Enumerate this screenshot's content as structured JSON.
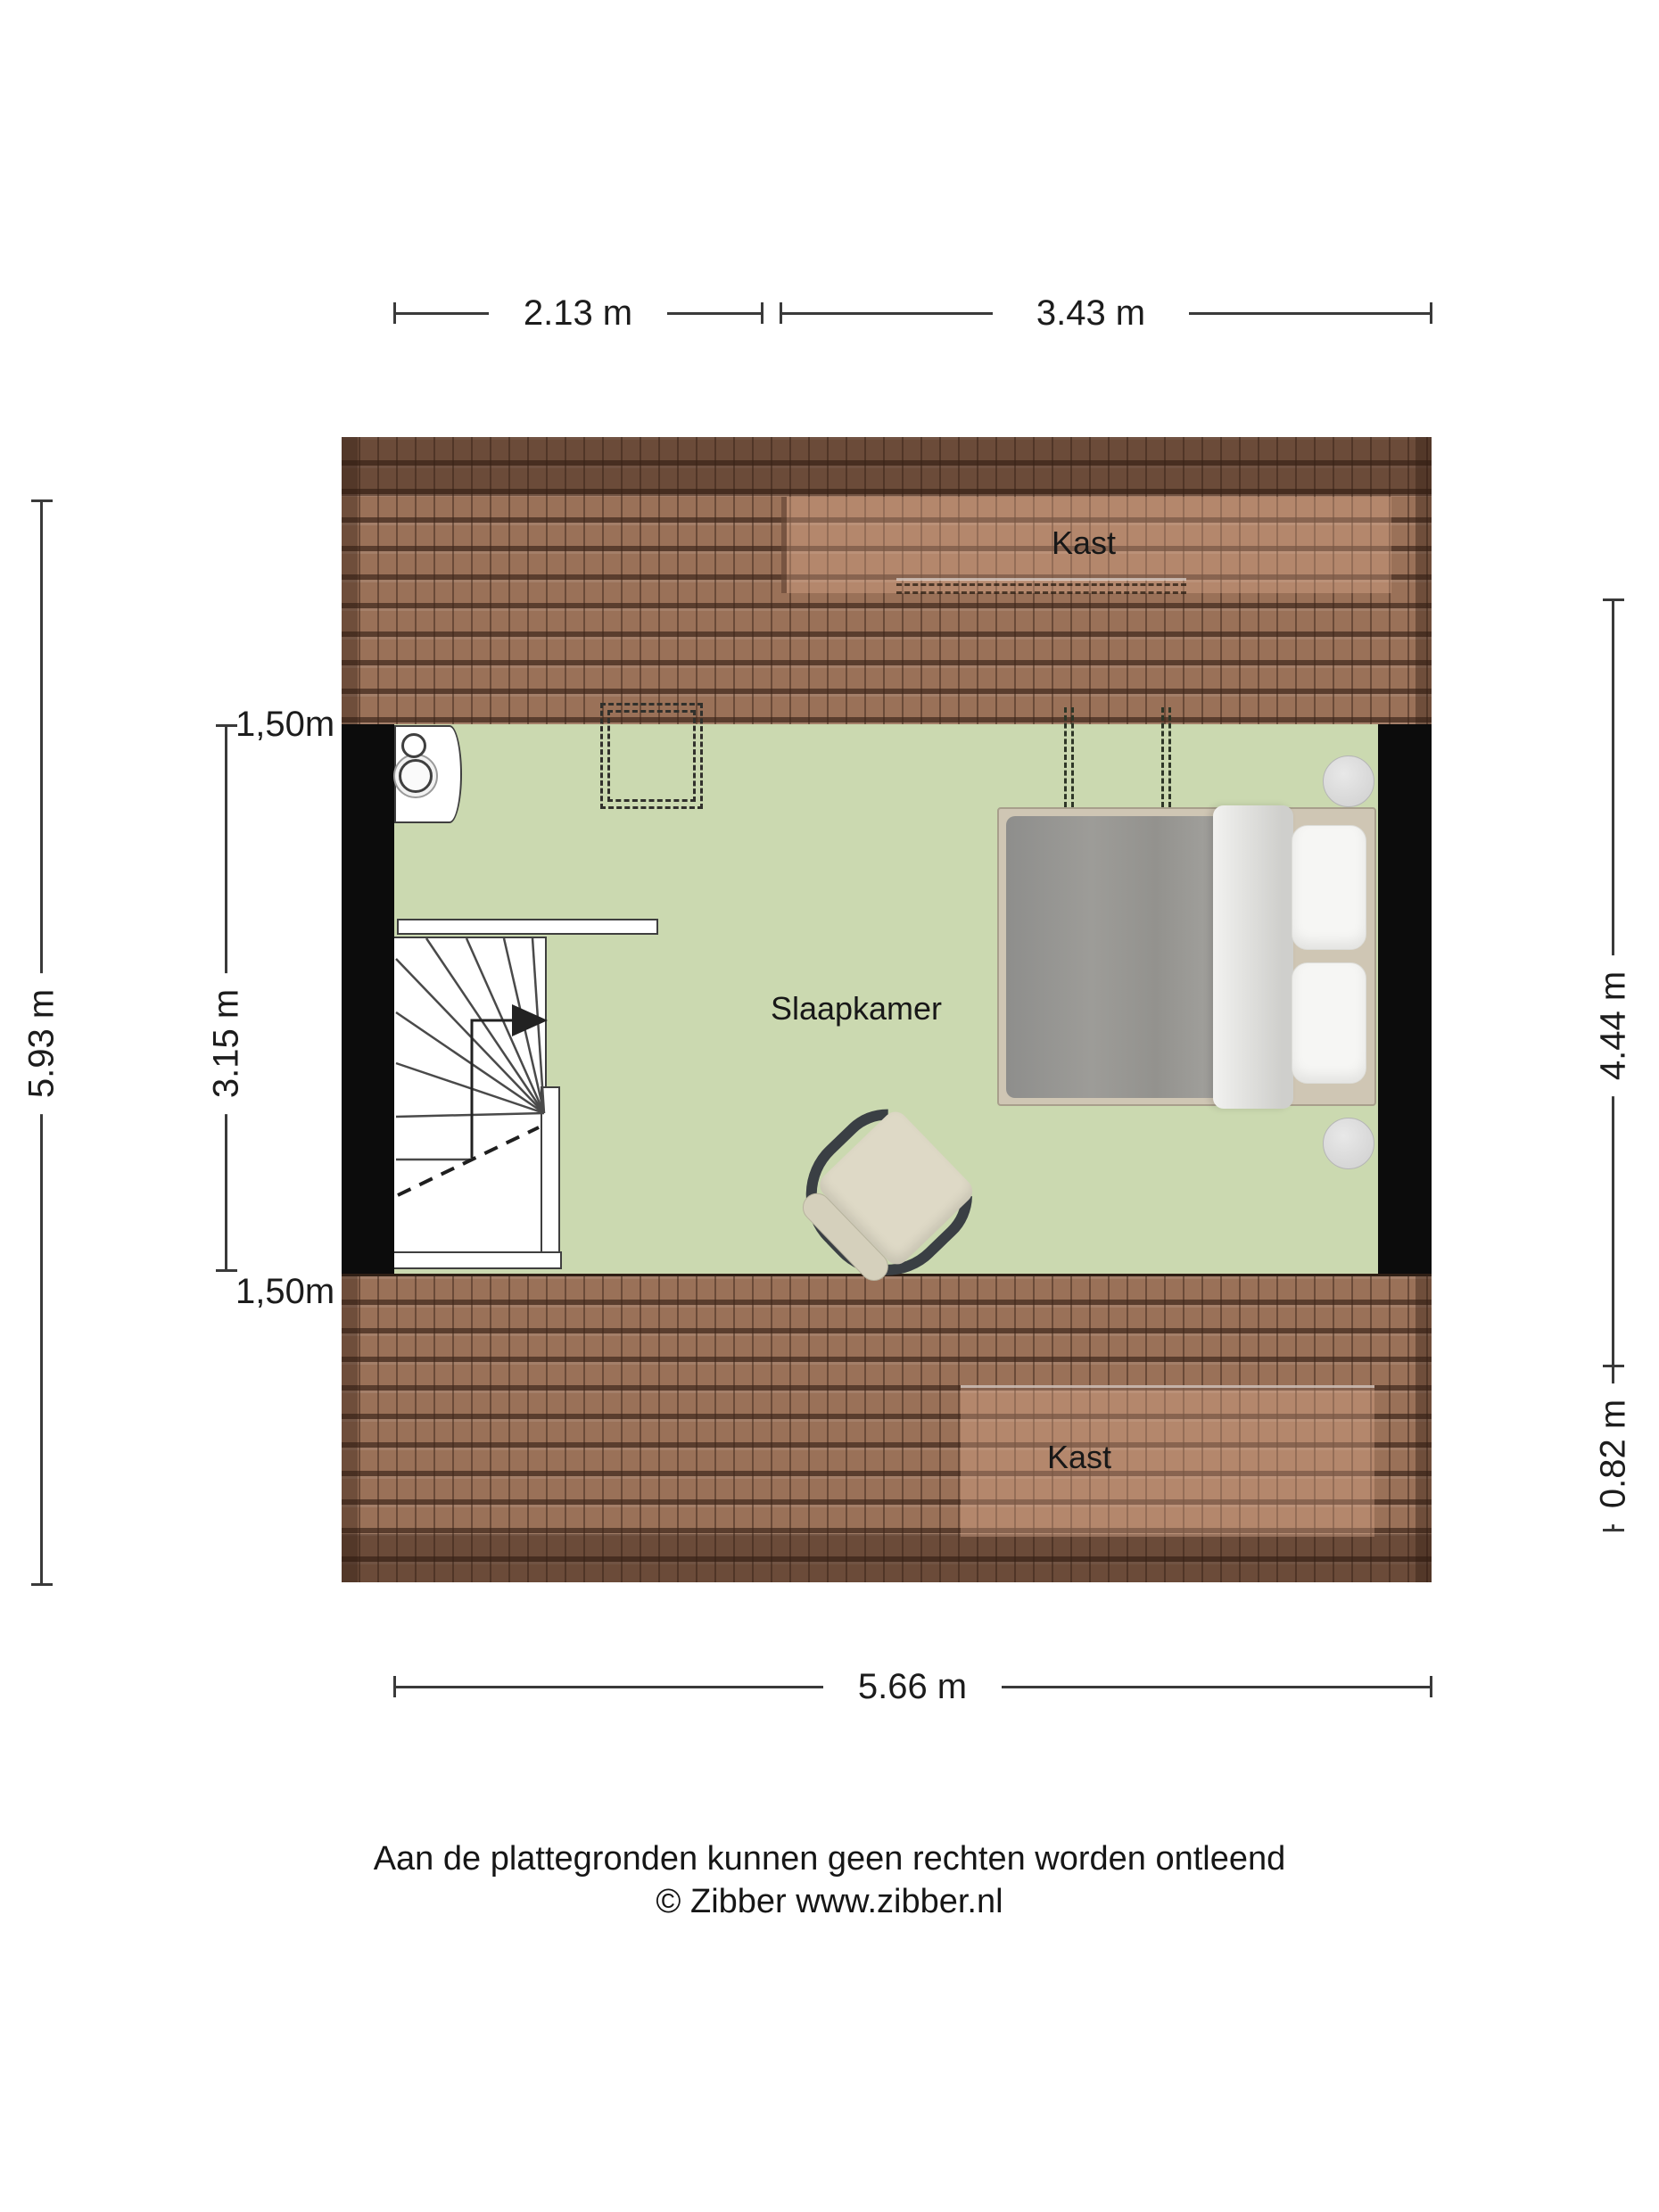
{
  "colors": {
    "floor": "#cbd9b0",
    "roof": "#9a7158",
    "wall": "#0c0c0c",
    "line": "#3f3f3f",
    "dash": "#2e3627",
    "text": "#1c1c1c"
  },
  "dimensions": {
    "top_left": "2.13 m",
    "top_right": "3.43 m",
    "bottom": "5.66 m",
    "left_outer": "5.93 m",
    "left_inner_height": "3.15 m",
    "left_knee_top": "1,50m",
    "left_knee_bottom": "1,50m",
    "right_room": "4.44 m",
    "right_closet": "0.82 m"
  },
  "rooms": {
    "bedroom": "Slaapkamer",
    "closet_top": "Kast",
    "closet_bottom": "Kast"
  },
  "footer": {
    "disclaimer": "Aan de plattegronden kunnen geen rechten worden ontleend",
    "copyright": "© Zibber www.zibber.nl"
  }
}
